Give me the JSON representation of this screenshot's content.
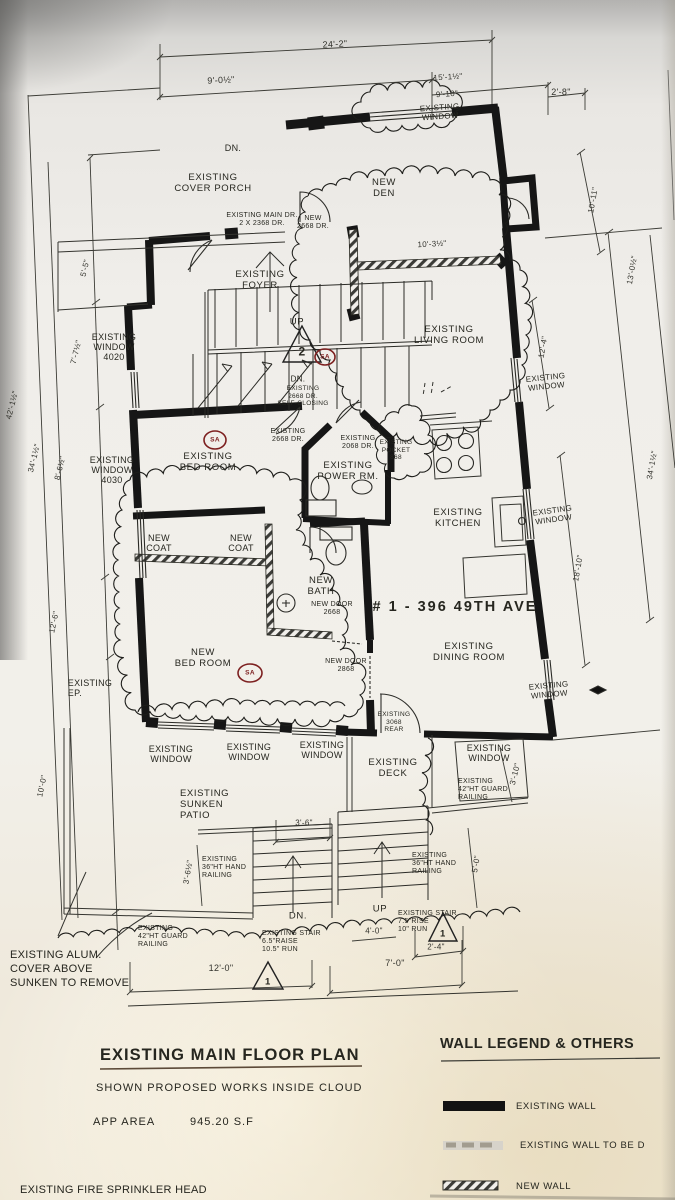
{
  "address": "# 1 - 396  49TH AVE",
  "title_block": {
    "title": "EXISTING MAIN FLOOR PLAN",
    "note": "SHOWN PROPOSED WORKS INSIDE CLOUD",
    "area_label": "APP AREA",
    "area_value": "945.20 S.F"
  },
  "legend": {
    "title": "WALL LEGEND & OTHERS",
    "items": [
      {
        "label": "EXISTING WALL",
        "style": "solid-black"
      },
      {
        "label": "EXISTING WALL TO BE D",
        "style": "faded-dashed"
      },
      {
        "label": "NEW WALL",
        "style": "hatched"
      }
    ]
  },
  "notes": {
    "alum": "EXISTING ALUM.\nCOVER ABOVE\nSUNKEN TO REMOVE",
    "sprinkler": "EXISTING FIRE SPRINKLER HEAD"
  },
  "markers": {
    "sa": "SA",
    "tri_2": "2",
    "tri_1": "1"
  },
  "rooms": {
    "cover_porch": "EXISTING\nCOVER PORCH",
    "den": "NEW\nDEN",
    "foyer": "EXISTING\nFOYER",
    "living": "EXISTING\nLIVING ROOM",
    "bed": "EXISTING\nBED ROOM",
    "power": "EXISTING\nPOWER RM.",
    "kitchen": "EXISTING\nKITCHEN",
    "coat": "NEW\nCOAT",
    "bath": "NEW\nBATH",
    "new_bed": "NEW\nBED ROOM",
    "dining": "EXISTING\nDINING ROOM",
    "deck": "EXISTING\nDECK",
    "patio": "EXISTING\nSUNKEN\nPATIO",
    "ep": "EXISTING\nEP."
  },
  "windows": {
    "top": "EXISTING\nWINDOW",
    "w4020": "EXISTING\nWINDOW\n4020",
    "w4030": "EXISTING\nWINDOW\n4030",
    "generic": "EXISTING\nWINDOW"
  },
  "doors": {
    "main": "EXISTING MAIN DR.\n2 X 2368 DR.",
    "new_den": "NEW\n2668 DR.",
    "self_closing": "EXISTING\n2668 DR.\nSELF-CLOSING",
    "bed": "EXISTING\n2668 DR.",
    "power": "EXISTING\n2068 DR.",
    "pocket": "EXISTING\nPOCKET\n868",
    "bath_new": "NEW DOOR\n2668",
    "bed_new": "NEW DOOR\n2868",
    "rear": "EXISTING\n3068\nREAR"
  },
  "railings": {
    "guard": "EXISTING\n42\"HT GUARD\nRAILING",
    "hand": "EXISTING\n36\"HT HAND\nRAILING"
  },
  "stairs": {
    "up": "UP",
    "dn": "DN.",
    "patio_stair": "EXISTING STAIR\n6.5\"RAISE\n10.5\" RUN",
    "deck_stair": "EXISTING STAIR\n7.5\"RISE\n10\" RUN"
  },
  "dims": {
    "t_overall": "24'-2\"",
    "t_left": "9'-0½\"",
    "t_mid": "15'-1½\"",
    "t_win": "9'-10\"",
    "t_right": "2'-8\"",
    "r_jog": "10'-11\"",
    "r_living": "12'-4\"",
    "r_kitchen": "18'-10\"",
    "r_inner": "13'-0½\"",
    "r_outer": "34'-1½\"",
    "l_outer": "42'-1½\"",
    "l_inner": "34'-1½\"",
    "l_top": "5'-5\"",
    "l_4020": "7'-7½\"",
    "l_4030": "8'-6½\"",
    "l_mid": "12'-6\"",
    "l_bottom": "10'-0\"",
    "den_wall": "10'-3½\"",
    "patio_door": "3'-6\"",
    "b_patio": "12'-0\"",
    "b_deck": "7'-0\"",
    "b_24": "2'-4\"",
    "b_40": "4'-0\"",
    "rail_36": "3'-6½\"",
    "rail_50": "5'-0\"",
    "deck_win": "3'-10\""
  }
}
